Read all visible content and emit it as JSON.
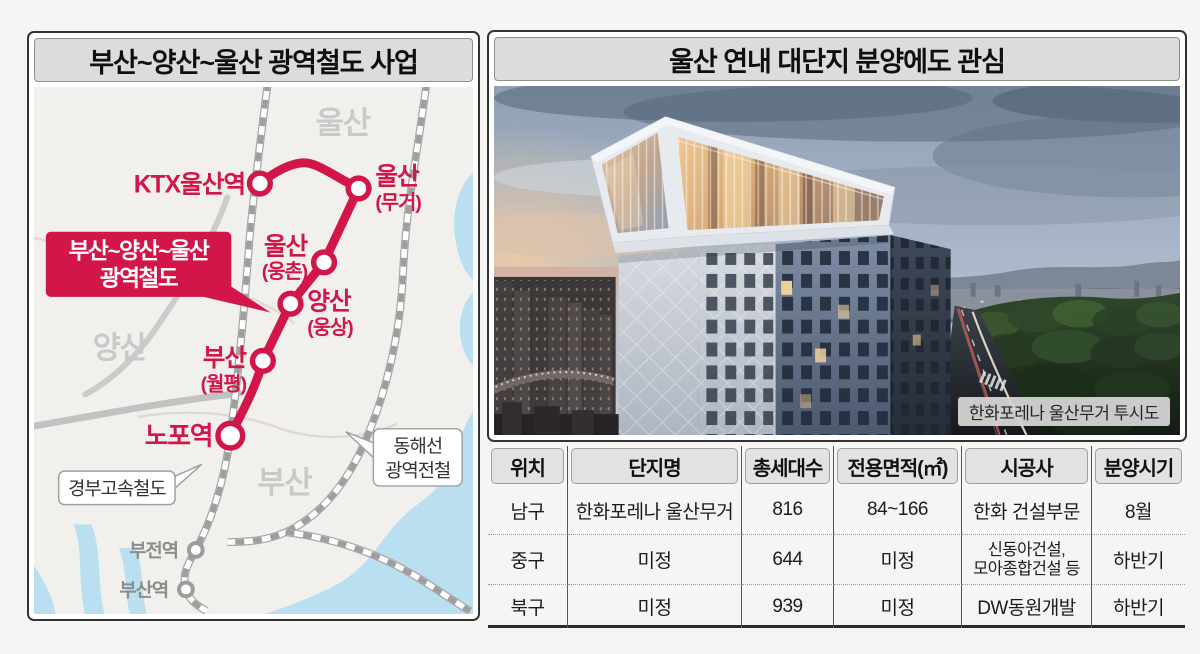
{
  "left_panel": {
    "title": "부산~양산~울산 광역철도 사업",
    "map": {
      "regions": [
        "울산",
        "양산",
        "부산"
      ],
      "callout": {
        "line1": "부산~양산~울산",
        "line2": "광역철도"
      },
      "stations": [
        {
          "name": "KTX울산역",
          "sub": ""
        },
        {
          "name": "울산",
          "sub": "(무거)"
        },
        {
          "name": "울산",
          "sub": "(웅촌)"
        },
        {
          "name": "양산",
          "sub": "(웅상)"
        },
        {
          "name": "부산",
          "sub": "(월평)"
        },
        {
          "name": "노포역",
          "sub": ""
        }
      ],
      "other_stations": [
        "부전역",
        "부산역"
      ],
      "rail_labels": {
        "gyeongbu": "경부고속철도",
        "donghae1": "동해선",
        "donghae2": "광역전철"
      },
      "colors": {
        "line_red": "#d2164a",
        "rail_gray": "#9e9e9e",
        "sea_blue": "#badff1",
        "region_label_gray": "#c9c9c9"
      }
    }
  },
  "right_panel": {
    "title": "울산 연내 대단지 분양에도 관심",
    "photo": {
      "caption": "한화포레나 울산무거 투시도"
    },
    "table": {
      "headers": [
        "위치",
        "단지명",
        "총세대수",
        "전용면적(㎡)",
        "시공사",
        "분양시기"
      ],
      "rows": [
        {
          "loc": "남구",
          "name": "한화포레나 울산무거",
          "units": "816",
          "area": "84~166",
          "builder": "한화 건설부문",
          "date": "8월"
        },
        {
          "loc": "중구",
          "name": "미정",
          "units": "644",
          "area": "미정",
          "builder": "신동아건설,\n모아종합건설 등",
          "date": "하반기"
        },
        {
          "loc": "북구",
          "name": "미정",
          "units": "939",
          "area": "미정",
          "builder": "DW동원개발",
          "date": "하반기"
        }
      ]
    }
  }
}
